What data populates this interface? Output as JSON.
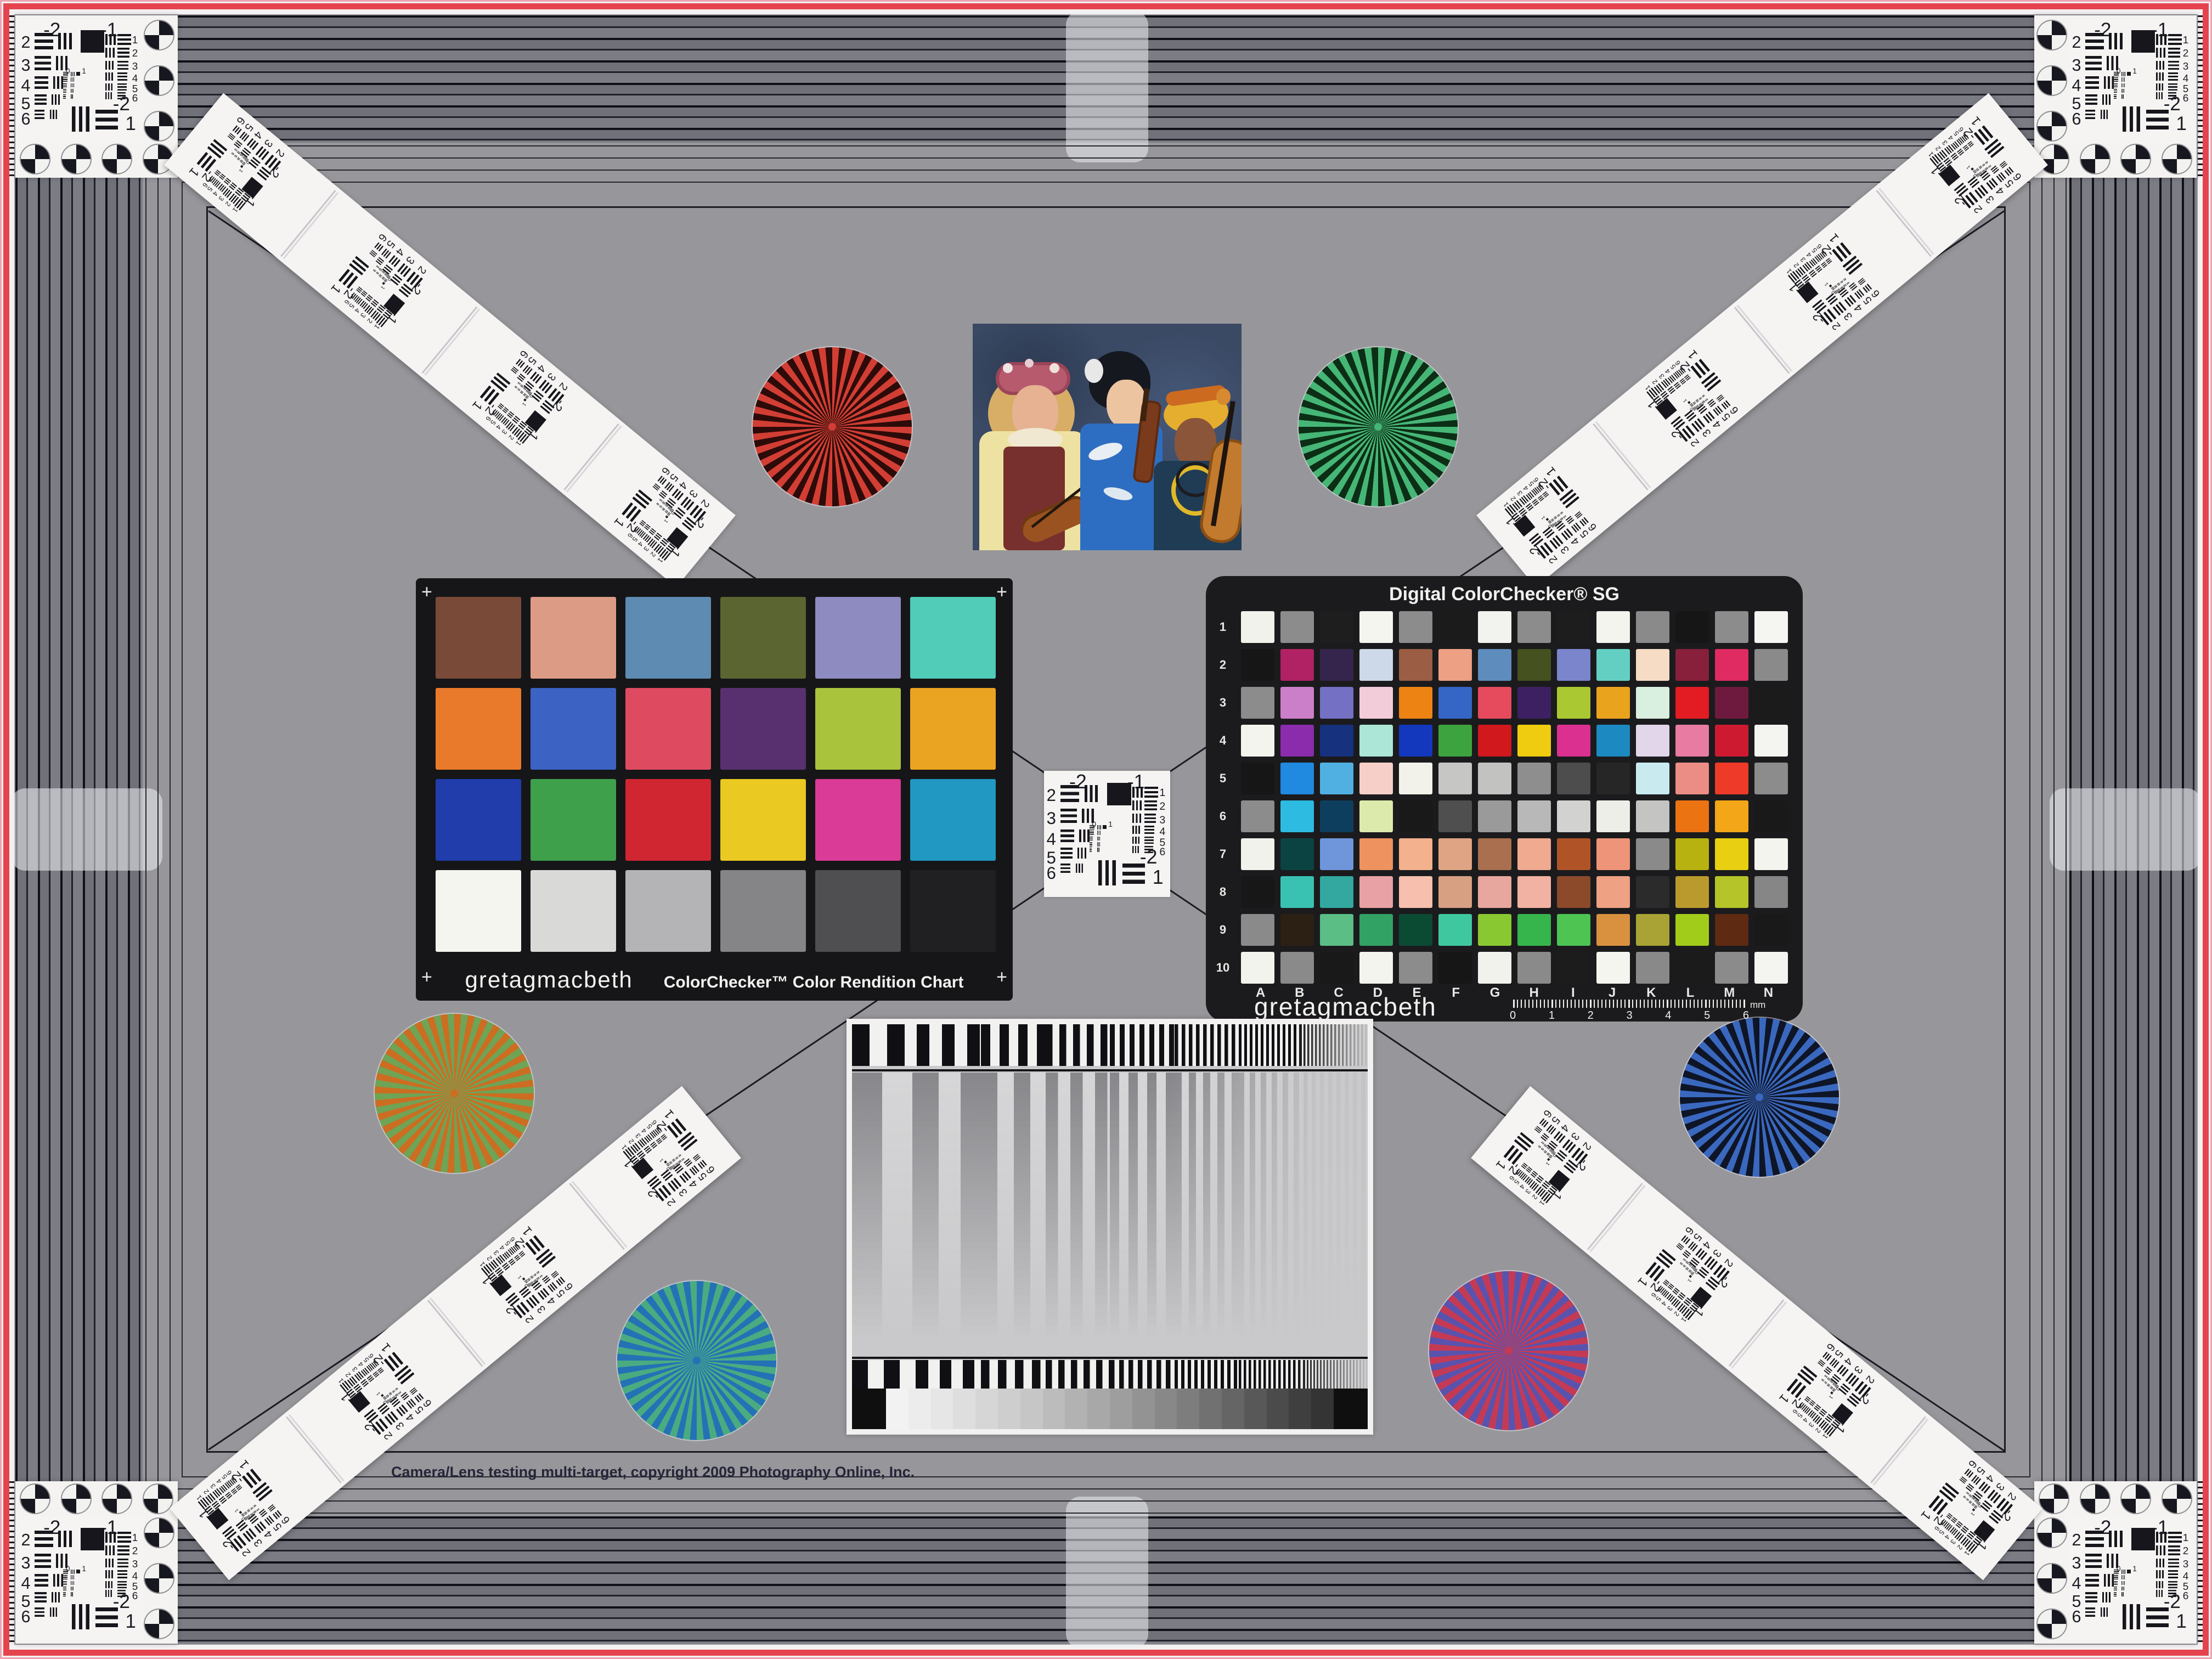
{
  "frame": {
    "red": "#e5444e",
    "pink": "#eda4b2",
    "field_gray": "#97979b",
    "band_dark": "#20202a",
    "band_mid": "#717179",
    "line_black": "#1a1a22"
  },
  "copyright": {
    "text": "Camera/Lens testing multi-target, copyright 2009 Photography Online, Inc."
  },
  "colorchecker": {
    "brand": "gretagmacbeth",
    "title": "ColorChecker™ Color Rendition Chart",
    "plus_mark": "+",
    "rows": [
      [
        "#7a4a38",
        "#dc9b85",
        "#5d8bb2",
        "#5a6531",
        "#8e8bc0",
        "#50ccb9"
      ],
      [
        "#e97a2b",
        "#3c63c4",
        "#de4b61",
        "#59306f",
        "#a9c33d",
        "#eba322"
      ],
      [
        "#203dab",
        "#3fa04c",
        "#d02631",
        "#e9c922",
        "#da3b96",
        "#2098c2"
      ],
      [
        "#f5f5f0",
        "#d9d9d7",
        "#b4b4b6",
        "#858587",
        "#4f4f51",
        "#202022"
      ]
    ]
  },
  "sg": {
    "title": "Digital ColorChecker® SG",
    "brand": "gretagmacbeth",
    "row_labels": [
      "1",
      "2",
      "3",
      "4",
      "5",
      "6",
      "7",
      "8",
      "9",
      "10"
    ],
    "col_labels": [
      "A",
      "B",
      "C",
      "D",
      "E",
      "F",
      "G",
      "H",
      "I",
      "J",
      "K",
      "L",
      "M",
      "N"
    ],
    "ruler_numbers": [
      "0",
      "1",
      "2",
      "3",
      "4",
      "5",
      "6"
    ],
    "ruler_unit": "mm",
    "rows": [
      [
        "#f2f2ed",
        "#8c8c8c",
        "#1e1e1e",
        "#f5f5f0",
        "#8c8c8c",
        "#1b1b1b",
        "#f2f2ef",
        "#8c8c8c",
        "#1d1d1d",
        "#f4f4ef",
        "#8a8a8a",
        "#161616",
        "#8c8c8c",
        "#f5f5f2"
      ],
      [
        "#161616",
        "#b02263",
        "#35254d",
        "#cdd8e8",
        "#9b5d43",
        "#eda084",
        "#5e8cbd",
        "#45511f",
        "#7a85cc",
        "#63cfc2",
        "#f6dcc5",
        "#88203c",
        "#e02a62",
        "#8a8a8a"
      ],
      [
        "#8c8c8c",
        "#ca7fc8",
        "#7470c4",
        "#f3ccd9",
        "#ec8313",
        "#3566c5",
        "#e64a5d",
        "#3c2061",
        "#a9c831",
        "#eaa31c",
        "#d9efdf",
        "#e31b22",
        "#6e1a3e",
        "#1b1b1b"
      ],
      [
        "#f4f4ef",
        "#8a2cab",
        "#16327e",
        "#abe6d6",
        "#1338bd",
        "#3da33e",
        "#d0181d",
        "#efcc0f",
        "#dc3090",
        "#1c89c1",
        "#e2d6eb",
        "#e87ba2",
        "#ce1a31",
        "#f4f4f1"
      ],
      [
        "#161616",
        "#2089e0",
        "#51b0e2",
        "#f6d0c8",
        "#f2f2ea",
        "#c6c6c4",
        "#c2c2c0",
        "#8e8e8e",
        "#4d4d4d",
        "#262626",
        "#c9ebf0",
        "#eb8d85",
        "#ee3a28",
        "#8c8c8c"
      ],
      [
        "#8c8c8c",
        "#2dbbe2",
        "#0e3e5e",
        "#dcebac",
        "#191919",
        "#4f4f4f",
        "#9a9a9a",
        "#b8b8b8",
        "#d2d2d0",
        "#eeeee8",
        "#c4c4c2",
        "#ec7312",
        "#f3a617",
        "#191919"
      ],
      [
        "#f2f2ec",
        "#0b4342",
        "#6f96da",
        "#ee9260",
        "#f3b18d",
        "#dfa483",
        "#a96f4e",
        "#f0aa90",
        "#b05428",
        "#ee9478",
        "#8a8a8a",
        "#b8b211",
        "#e9cf11",
        "#f4f4ee"
      ],
      [
        "#171717",
        "#39c2b2",
        "#32a8a0",
        "#e8a1a5",
        "#f6bfae",
        "#d8a083",
        "#e7a79e",
        "#f2b2a3",
        "#8c4a2b",
        "#efa183",
        "#2b2b2b",
        "#bb9a2d",
        "#b5c428",
        "#868686"
      ],
      [
        "#8a8a8a",
        "#2c2015",
        "#5abe85",
        "#32a264",
        "#0b4a33",
        "#3fc8a0",
        "#8ac832",
        "#35b54c",
        "#4ec453",
        "#d9913f",
        "#a8a334",
        "#a2cc1a",
        "#5e2a12",
        "#191919"
      ],
      [
        "#f3f3ee",
        "#8a8a8a",
        "#191919",
        "#f4f4ef",
        "#8c8c8c",
        "#161616",
        "#f2f2ed",
        "#8a8a8a",
        "#1c1c1c",
        "#f5f5f0",
        "#898989",
        "#1b1b1b",
        "#8b8b8b",
        "#f4f4f1"
      ]
    ]
  },
  "usaf": {
    "top_left": "-2",
    "top_right": "-1",
    "left_numbers": [
      "2",
      "3",
      "4",
      "5",
      "6"
    ],
    "right_numbers": [
      "1",
      "2",
      "3",
      "4",
      "5",
      "6"
    ],
    "bottom_top": "-2",
    "bottom_num": "1",
    "mini_left": "0",
    "mini_right": "1"
  },
  "stars": [
    {
      "name": "red",
      "spoke": "#d23e34",
      "gap": "#2d0b09"
    },
    {
      "name": "green",
      "spoke": "#46b676",
      "gap": "#0b2e15"
    },
    {
      "name": "gold",
      "spoke": "#cc6d22",
      "gap": "#6fa355"
    },
    {
      "name": "blue",
      "spoke": "#3a68bf",
      "gap": "#0e1526"
    },
    {
      "name": "teal",
      "spoke": "#2472b5",
      "gap": "#4aab81"
    },
    {
      "name": "magenta",
      "spoke": "#c43a55",
      "gap": "#5953ae"
    }
  ],
  "photo": {
    "background": "#3a4964",
    "kimono_blue": "#2e6ec2",
    "vest_red": "#77302d",
    "blouse_yellow": "#eee2a2",
    "headwrap_yellow": "#e6ae2e",
    "cello_orange": "#c17a2e"
  },
  "sweep": {
    "end_block": "#0f0f0f",
    "gray_steps": [
      "#f2f2f2",
      "#ececec",
      "#e6e6e6",
      "#dedede",
      "#d6d6d6",
      "#cecece",
      "#c6c6c6",
      "#bcbcbc",
      "#b2b2b2",
      "#a8a8a8",
      "#9e9e9e",
      "#939393",
      "#888888",
      "#7d7d7d",
      "#717171",
      "#656565",
      "#585858",
      "#4b4b4b",
      "#3f3f3f",
      "#343434"
    ]
  }
}
